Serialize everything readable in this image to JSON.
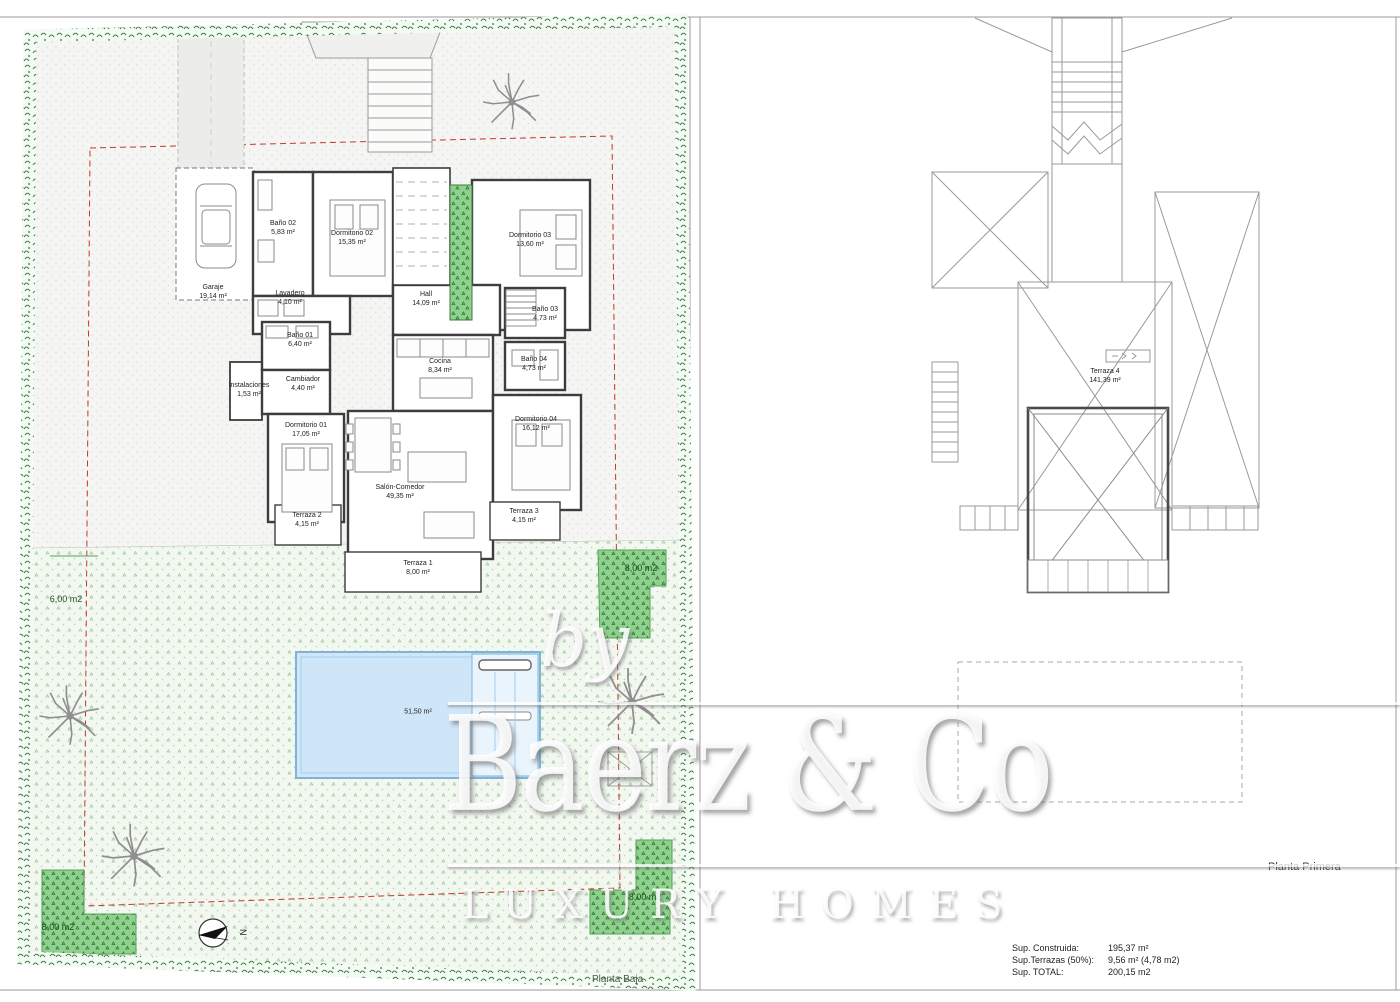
{
  "sheet": {
    "left_title": "Planta Baja",
    "right_title": "Planta Primera"
  },
  "rooms": {
    "garaje": {
      "name": "Garaje",
      "area": "19,14 m²"
    },
    "bano02": {
      "name": "Baño 02",
      "area": "5,83 m²"
    },
    "dorm02": {
      "name": "Dormitorio 02",
      "area": "15,35 m²"
    },
    "dorm03": {
      "name": "Dormitorio 03",
      "area": "13,60 m²"
    },
    "lavadero": {
      "name": "Lavadero",
      "area": "4,10 m²"
    },
    "bano01": {
      "name": "Baño 01",
      "area": "6,40 m²"
    },
    "instalaciones": {
      "name": "Instalaciones",
      "area": "1,53 m²"
    },
    "cambiador": {
      "name": "Cambiador",
      "area": "4,40 m²"
    },
    "hall": {
      "name": "Hall",
      "area": "14,09 m²"
    },
    "cocina": {
      "name": "Cocina",
      "area": "8,34 m²"
    },
    "bano03": {
      "name": "Baño 03",
      "area": "4,73 m²"
    },
    "bano04": {
      "name": "Baño 04",
      "area": "4,73 m²"
    },
    "dorm01": {
      "name": "Dormitorio 01",
      "area": "17,05 m²"
    },
    "dorm04": {
      "name": "Dormitorio 04",
      "area": "16,12 m²"
    },
    "salon": {
      "name": "Salón-Comedor",
      "area": "49,35 m²"
    },
    "terraza1": {
      "name": "Terraza 1",
      "area": "8,00 m²"
    },
    "terraza2": {
      "name": "Terraza 2",
      "area": "4,15 m²"
    },
    "terraza3": {
      "name": "Terraza 3",
      "area": "4,15 m²"
    },
    "terraza4": {
      "name": "Terraza 4",
      "area": "141,39 m²"
    }
  },
  "pool": {
    "area": "51,50 m²"
  },
  "garden": {
    "left": "6,00 m2",
    "right": "8,00 m2",
    "bottom_left": "8,00 m2",
    "bottom_right": "8,00 m2"
  },
  "compass": {
    "label": "N"
  },
  "watermark": {
    "by": "by",
    "brand": "Baerz & Co",
    "tagline": "LUXURY HOMES"
  },
  "summary": {
    "rows": [
      {
        "label": "Sup. Construida:",
        "value": "195,37 m²"
      },
      {
        "label": "Sup.Terrazas (50%):",
        "value": "9,56 m² (4,78 m2)"
      },
      {
        "label": "Sup. TOTAL:",
        "value": "200,15 m2"
      }
    ]
  }
}
